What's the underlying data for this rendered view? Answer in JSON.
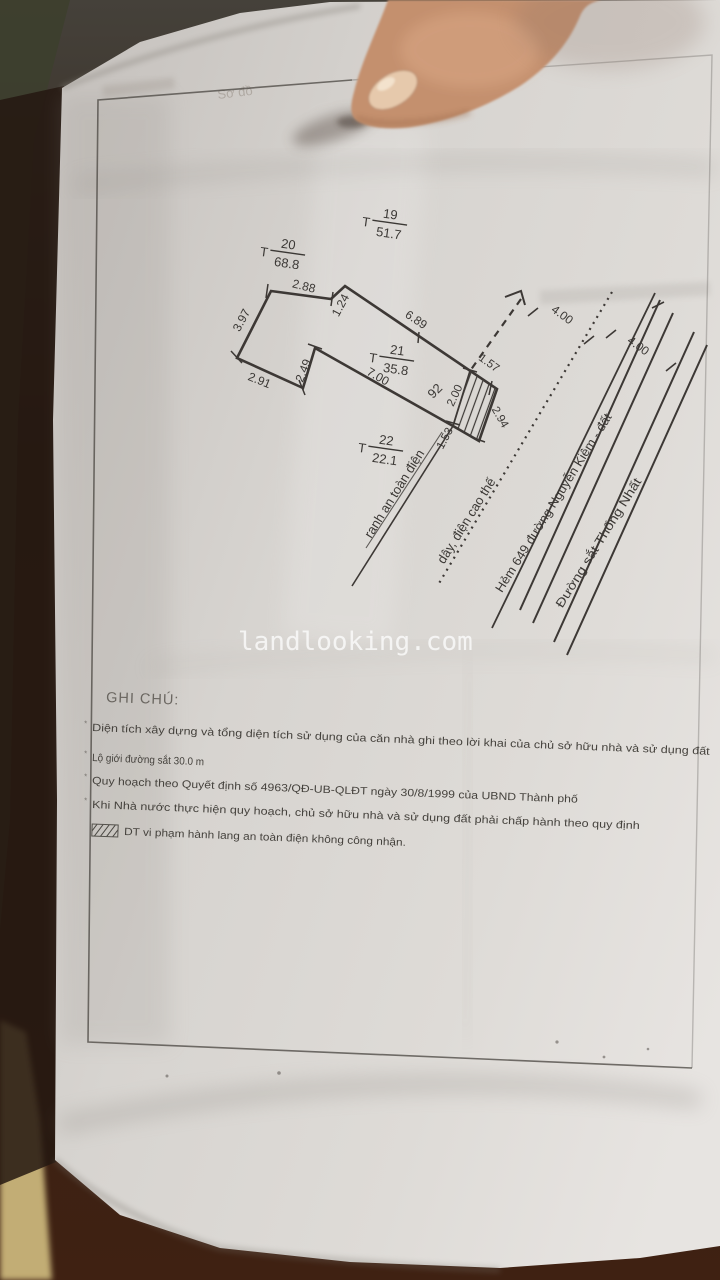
{
  "photo": {
    "faint_header": "Sơ đồ",
    "watermark": "landlooking.com"
  },
  "diagram": {
    "lot_number": "92",
    "markers": [
      {
        "prefix": "T",
        "num": "19",
        "den": "51.7"
      },
      {
        "prefix": "T",
        "num": "20",
        "den": "68.8"
      },
      {
        "prefix": "T",
        "num": "21",
        "den": "35.8"
      },
      {
        "prefix": "T",
        "num": "22",
        "den": "22.1"
      }
    ],
    "dims": {
      "top": "2.88",
      "step": "1.24",
      "north": "6.89",
      "west": "3.97",
      "southwest": "2.91",
      "step2": "2.49",
      "south": "7.00",
      "hatch_top": "1.57",
      "hatch_left": "2.00",
      "hatch_right": "2.94",
      "hatch_bottom": "1.53",
      "alley_width_1": "4.00",
      "alley_width_2": "4.00"
    },
    "labels": {
      "safety_line": "ranh an toàn điện",
      "power_line": "dây, điện cao thế",
      "alley": "Hẻm 649 đường Nguyễn Kiệm - đất",
      "railway": "Đường sắt Thống Nhất"
    }
  },
  "notes": {
    "heading": "GHI CHÚ:",
    "bullet": "*",
    "items": [
      "Diện tích xây dựng và tổng diện tích sử dụng của căn nhà ghi theo lời khai của chủ sở  hữu nhà và sử dụng đất",
      "Lộ giới đường sắt 30.0 m",
      "Quy hoạch theo Quyết định số  4963/QĐ-UB-QLĐT ngày  30/8/1999 của UBND Thành phố",
      "Khi Nhà nước thực hiện quy hoạch, chủ sở hữu nhà và sử dụng đất phải chấp hành theo quy định",
      "DT vi phạm hành lang an toàn điện không công nhận."
    ]
  }
}
